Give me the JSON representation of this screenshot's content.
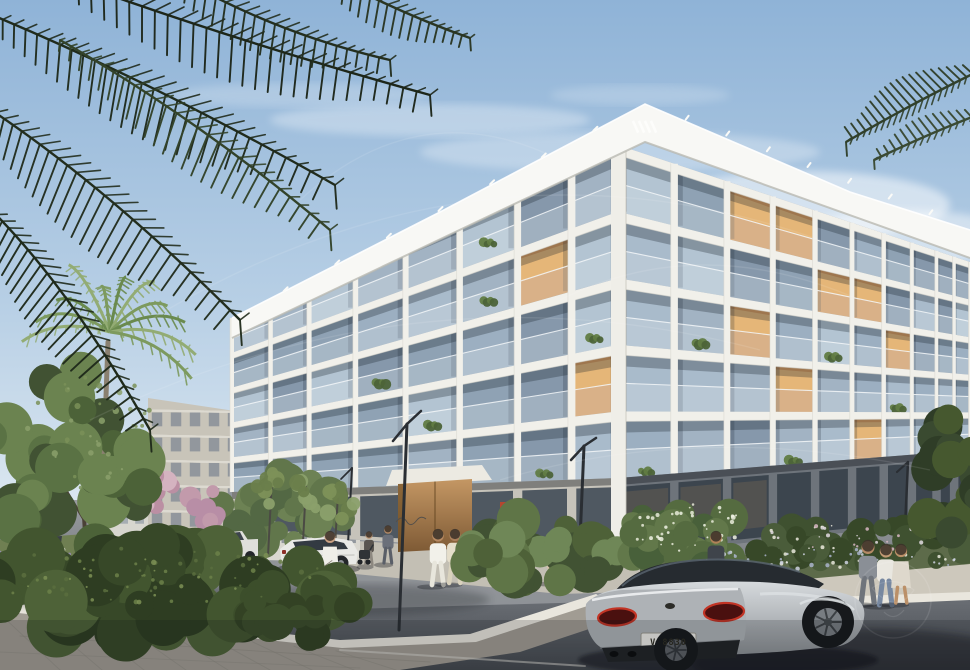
{
  "meta": {
    "title": "Architectural rendering - modern residential building on a landscaped street corner",
    "style": "photorealistic exterior visualization, daytime"
  },
  "scene": {
    "sky": {
      "top": "#8fb3d7",
      "mid": "#b7cfe5",
      "bottom": "#e0eaf2"
    },
    "clouds": [
      [
        430,
        120,
        160,
        16,
        0.3
      ],
      [
        620,
        152,
        200,
        20,
        0.28
      ],
      [
        300,
        95,
        130,
        12,
        0.2
      ],
      [
        800,
        205,
        150,
        34,
        0.5
      ],
      [
        905,
        238,
        110,
        28,
        0.45
      ],
      [
        715,
        252,
        170,
        24,
        0.35
      ],
      [
        640,
        95,
        90,
        10,
        0.18
      ]
    ],
    "building": {
      "label": "main-apartment-building",
      "floors": 5,
      "fascia": "#f8f8f5",
      "pier": "#f1f0ea",
      "pierShade": "#d8d6cd",
      "cornerPier": "#efeee8",
      "glassPalette": [
        "#a9bbcb",
        "#9cafc1",
        "#8fa2b4",
        "#b3c4d2",
        "#8698ab",
        "#a2b3c3"
      ],
      "warmGlass": "#d79a5c",
      "warmGlassHi": "#e9bd80",
      "left": {
        "xCorner": 618,
        "xFar": 232,
        "span": 386,
        "linesNear": [
          145,
          211.6,
          278.2,
          344.8,
          411.4,
          478
        ],
        "linesFar": [
          318,
          352.8,
          387.6,
          422.4,
          457.2,
          492
        ],
        "baseNear": 556,
        "baseFar": 532,
        "bays": [
          0,
          0.12,
          0.26,
          0.41,
          0.55,
          0.68,
          0.8,
          0.9,
          1
        ],
        "warm": [
          [
            1,
            1
          ],
          [
            0,
            3
          ]
        ],
        "plants": [
          [
            0,
            2
          ],
          [
            2,
            1
          ],
          [
            3,
            3
          ],
          [
            1,
            4
          ],
          [
            4,
            2
          ],
          [
            5,
            4
          ],
          [
            2,
            0
          ]
        ]
      },
      "right": {
        "xCorner": 618,
        "xFar": 970,
        "span": 352,
        "linesNear": [
          145,
          211.6,
          278.2,
          344.8,
          411.4,
          478
        ],
        "linesFar": [
          262,
          299.6,
          337.2,
          374.8,
          412.4,
          450
        ],
        "baseNear": 556,
        "baseFar": 520,
        "bays": [
          0,
          0.16,
          0.31,
          0.44,
          0.56,
          0.665,
          0.755,
          0.835,
          0.905,
          0.955,
          1
        ],
        "warm": [
          [
            2,
            0
          ],
          [
            3,
            0
          ],
          [
            4,
            1
          ],
          [
            5,
            1
          ],
          [
            2,
            2
          ],
          [
            6,
            2
          ],
          [
            3,
            3
          ],
          [
            5,
            4
          ]
        ],
        "plants": [
          [
            1,
            2
          ],
          [
            4,
            2
          ],
          [
            0,
            4
          ],
          [
            6,
            3
          ],
          [
            3,
            4
          ]
        ]
      },
      "fasciaPts": {
        "apex": [
          645,
          104
        ],
        "leftTop": [
          232,
          318
        ],
        "leftBot": [
          232,
          338
        ],
        "apexBot": [
          645,
          142
        ],
        "rightTop": [
          970,
          230
        ],
        "rightBot": [
          970,
          258
        ],
        "rightMid": [
          850,
          192
        ],
        "leftMid": [
          440,
          212
        ]
      },
      "groundLeftWall": "#c6c3ba",
      "groundRightWall": "#6e747b",
      "storeGlassLeft": "#49525c",
      "storeGlassRight": "#39424c",
      "entrance": {
        "x1": 398,
        "x2": 472,
        "wood1": "#b5895a",
        "wood2": "#7e5a35",
        "frame": "#e4e1d8"
      },
      "artwork": {
        "x": 500,
        "y": 502,
        "w": 11,
        "h": 21,
        "color": "#c0452b"
      },
      "roofLogoColor": "#fdfdfb"
    },
    "distantBuildings": [
      {
        "pts": [
          [
            100,
            455
          ],
          [
            148,
            450
          ],
          [
            148,
            535
          ],
          [
            100,
            537
          ]
        ],
        "fill": "#d7d6cf",
        "win": "#9aa3ab",
        "rows": 4,
        "cols": 3
      },
      {
        "pts": [
          [
            148,
            398
          ],
          [
            262,
            415
          ],
          [
            262,
            542
          ],
          [
            148,
            542
          ]
        ],
        "fill": "#c8c4b9",
        "win": "#848c96",
        "rows": 5,
        "cols": 6
      },
      {
        "pts": [
          [
            262,
            480
          ],
          [
            360,
            498
          ],
          [
            360,
            562
          ],
          [
            262,
            560
          ]
        ],
        "fill": "#d9d7d0",
        "win": "#7f8791",
        "rows": 2,
        "cols": 6
      }
    ],
    "ground": {
      "asphaltTop": "#9a9da1",
      "asphaltBottom": "#4a4e54",
      "apron": "#c3bfb4",
      "pavers": "#a19c93",
      "paverLine": "#8d887f",
      "curb": "#e9e6dd",
      "rightWalk": "#cdc8bc",
      "lawn": "#6f7f52",
      "bedGreen": "#5d6b4a"
    },
    "vehicles": {
      "bentley": {
        "label": "silver-bentley-coupe",
        "body1": "#cdd1d4",
        "body2": "#989da1",
        "rear": "#aeb2b6",
        "glass": "#262b30",
        "glassHi": "#5a6570",
        "tailDark": "#4a100f",
        "tailRing": "#c23425",
        "diffuser": "#212427",
        "plateFill": "#edece7",
        "plate_text": "V 8830",
        "wheel": "#17191c",
        "rim": "#787d82"
      },
      "suv": {
        "label": "white-suv",
        "body": "#e9e9e6",
        "glass": "#333a42"
      },
      "pickup": {
        "label": "white-pickup",
        "body": "#dfdfdb",
        "glass": "#3c434b"
      },
      "darkCar": {
        "label": "parked-dark-car",
        "body": "#3a3f45"
      }
    },
    "people": [
      {
        "x": 172,
        "y": 554,
        "h": 27,
        "top": "#3a3f45",
        "bottom": "#2e3237",
        "skin": "#b08a6a",
        "kind": "std"
      },
      {
        "x": 330,
        "y": 584,
        "h": 52,
        "top": "#efeee8",
        "bottom": "#e6e4da",
        "skin": "#caa184",
        "kind": "dress",
        "dog": true
      },
      {
        "x": 369,
        "y": 565,
        "h": 33,
        "top": "#5a5550",
        "bottom": "#8d8880",
        "skin": "#c09a78",
        "kind": "std",
        "stroller": true
      },
      {
        "x": 388,
        "y": 563,
        "h": 37,
        "top": "#6b707a",
        "bottom": "#5a5f68",
        "skin": "#b58a66",
        "kind": "std"
      },
      {
        "x": 438,
        "y": 585,
        "h": 55,
        "top": "#f2f1ea",
        "bottom": "#e8e6dc",
        "skin": "#b78a62",
        "kind": "std"
      },
      {
        "x": 455,
        "y": 583,
        "h": 53,
        "top": "#e5decb",
        "bottom": "#d9d2bd",
        "skin": "#a97f5c",
        "kind": "std"
      },
      {
        "x": 556,
        "y": 582,
        "h": 52,
        "top": "#d9c3a8",
        "bottom": "#d9c3a8",
        "skin": "#b98e66",
        "kind": "dress"
      },
      {
        "x": 716,
        "y": 588,
        "h": 56,
        "top": "#3f444b",
        "bottom": "#cfccc4",
        "skin": "#b08258",
        "kind": "std"
      },
      {
        "x": 868,
        "y": 603,
        "h": 62,
        "top": "#8a8f96",
        "bottom": "#6f747b",
        "skin": "#b58a66",
        "kind": "std"
      },
      {
        "x": 886,
        "y": 605,
        "h": 60,
        "top": "#e9e7e0",
        "bottom": "#7788a0",
        "skin": "#c29a74",
        "kind": "std"
      },
      {
        "x": 901,
        "y": 603,
        "h": 58,
        "top": "#ded8cc",
        "bottom": "#c9c2b4",
        "skin": "#bb9068",
        "kind": "dress"
      }
    ],
    "lamps": [
      {
        "pole": [
          [
            407,
            424
          ],
          [
            399,
            630
          ]
        ],
        "arms": [
          [
            [
              407,
              424
            ],
            [
              393,
              441
            ]
          ],
          [
            [
              407,
              424
            ],
            [
              421,
              411
            ]
          ]
        ],
        "w": 3
      },
      {
        "pole": [
          [
            352,
            468
          ],
          [
            346,
            582
          ]
        ],
        "arms": [
          [
            [
              352,
              468
            ],
            [
              341,
              479
            ]
          ]
        ],
        "w": 2
      },
      {
        "pole": [
          [
            584,
            446
          ],
          [
            578,
            588
          ]
        ],
        "arms": [
          [
            [
              584,
              446
            ],
            [
              571,
              460
            ]
          ],
          [
            [
              584,
              446
            ],
            [
              596,
              438
            ]
          ]
        ],
        "w": 3
      },
      {
        "pole": [
          [
            908,
            462
          ],
          [
            903,
            572
          ]
        ],
        "arms": [
          [
            [
              908,
              462
            ],
            [
              897,
              472
            ]
          ]
        ],
        "w": 2.5
      },
      {
        "pole": [
          [
            301,
            492
          ],
          [
            299,
            578
          ]
        ],
        "arms": [],
        "w": 1.5
      }
    ],
    "frondColor": "#1e2919",
    "frondColor2": "#2e3c26",
    "frondRight": "#31402b",
    "fronds": [
      {
        "a": [
          40,
          -30
        ],
        "c": [
          230,
          40
        ],
        "b": [
          430,
          95
        ],
        "len": 60,
        "col": "#1d2619",
        "n": 30
      },
      {
        "a": [
          -20,
          10
        ],
        "c": [
          150,
          80
        ],
        "b": [
          335,
          185
        ],
        "len": 68,
        "col": "#202b1c",
        "n": 30
      },
      {
        "a": [
          -40,
          90
        ],
        "c": [
          90,
          170
        ],
        "b": [
          240,
          320
        ],
        "len": 72,
        "col": "#232e1e",
        "n": 30
      },
      {
        "a": [
          -30,
          190
        ],
        "c": [
          60,
          270
        ],
        "b": [
          150,
          430
        ],
        "len": 62,
        "col": "#1f2a1b",
        "n": 28
      },
      {
        "a": [
          150,
          -40
        ],
        "c": [
          260,
          30
        ],
        "b": [
          390,
          60
        ],
        "len": 46,
        "col": "#242f1f",
        "n": 24
      },
      {
        "a": [
          300,
          -40
        ],
        "c": [
          390,
          10
        ],
        "b": [
          470,
          38
        ],
        "len": 36,
        "col": "#2a3623",
        "n": 20
      },
      {
        "a": [
          60,
          40
        ],
        "c": [
          200,
          120
        ],
        "b": [
          330,
          230
        ],
        "len": 58,
        "col": "#33432a",
        "n": 26
      }
    ],
    "frondsRight": [
      {
        "a": [
          985,
          68
        ],
        "c": [
          918,
          100
        ],
        "b": [
          846,
          142
        ],
        "len": 40,
        "col": "#31402b",
        "n": 22
      },
      {
        "a": [
          985,
          112
        ],
        "c": [
          932,
          132
        ],
        "b": [
          874,
          160
        ],
        "len": 26,
        "col": "#3a4a33",
        "n": 16
      }
    ],
    "palm": {
      "cx": 110,
      "cy": 332,
      "trunk": "#8a8070",
      "fronds": 11,
      "cols": [
        "#93ac74",
        "#7d9a5e",
        "#6a8a4e"
      ]
    },
    "watermarkOpacity": 0.1
  }
}
